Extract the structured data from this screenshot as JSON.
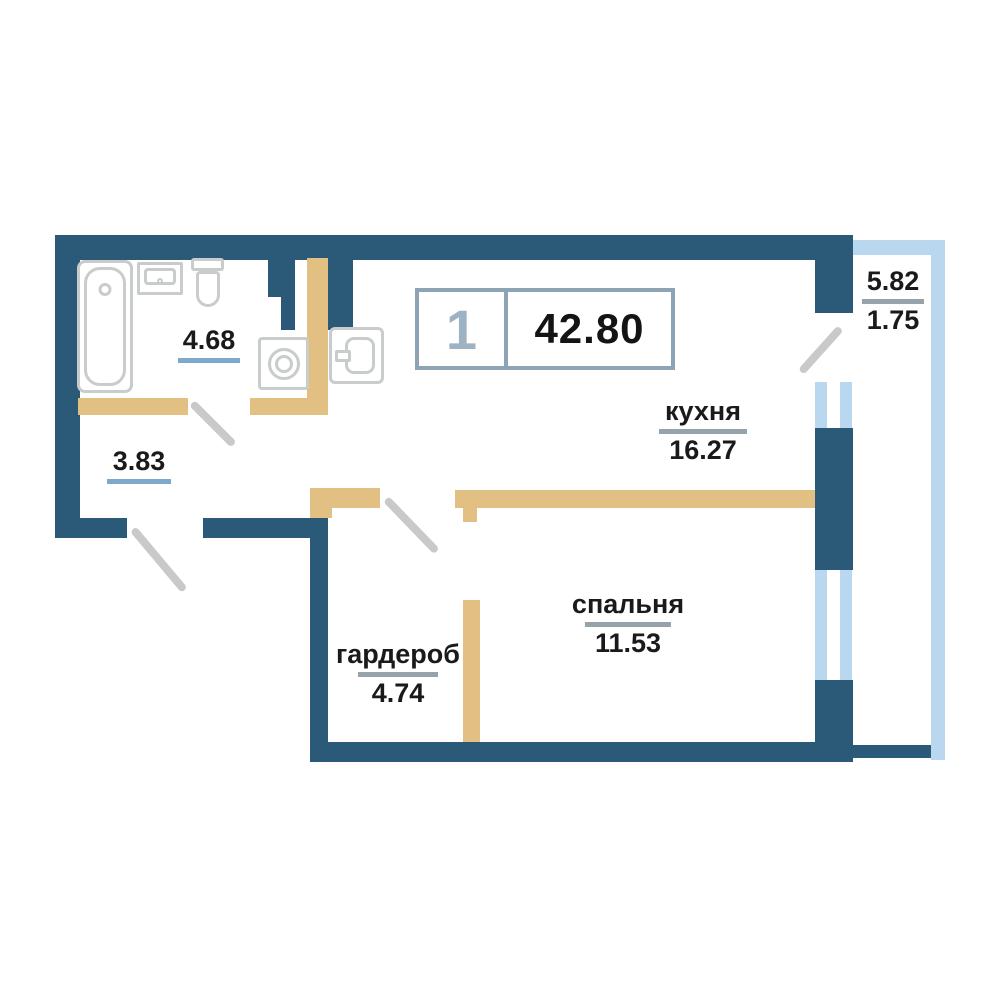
{
  "badge": {
    "rooms_count": "1",
    "total_area": "42.80"
  },
  "rooms": {
    "bathroom": {
      "area": "4.68"
    },
    "hallway": {
      "area": "3.83"
    },
    "kitchen": {
      "label": "кухня",
      "area": "16.27"
    },
    "bedroom": {
      "label": "спальня",
      "area": "11.53"
    },
    "wardrobe": {
      "label": "гардероб",
      "area": "4.74"
    },
    "balcony": {
      "area_total": "5.82",
      "area_reduced": "1.75"
    }
  },
  "icons": {
    "bathtub": "css-shape",
    "bathroom_sink": "css-shape",
    "toilet": "css-shape",
    "washing_machine": "css-shape",
    "kitchen_sink": "css-shape",
    "door_swing": "css-line",
    "window": "css-double-strip"
  },
  "colors": {
    "wall": "#2b5a79",
    "partition": "#e2c083",
    "glass": "#b9d7ee",
    "fixture": "#c9cccc",
    "swing": "#c9c9c9",
    "underline_blue": "#7fa9cb",
    "underline_gray": "#97a3ab",
    "badge_border": "#8ca4b4",
    "badge_digit": "#9db2c2"
  }
}
